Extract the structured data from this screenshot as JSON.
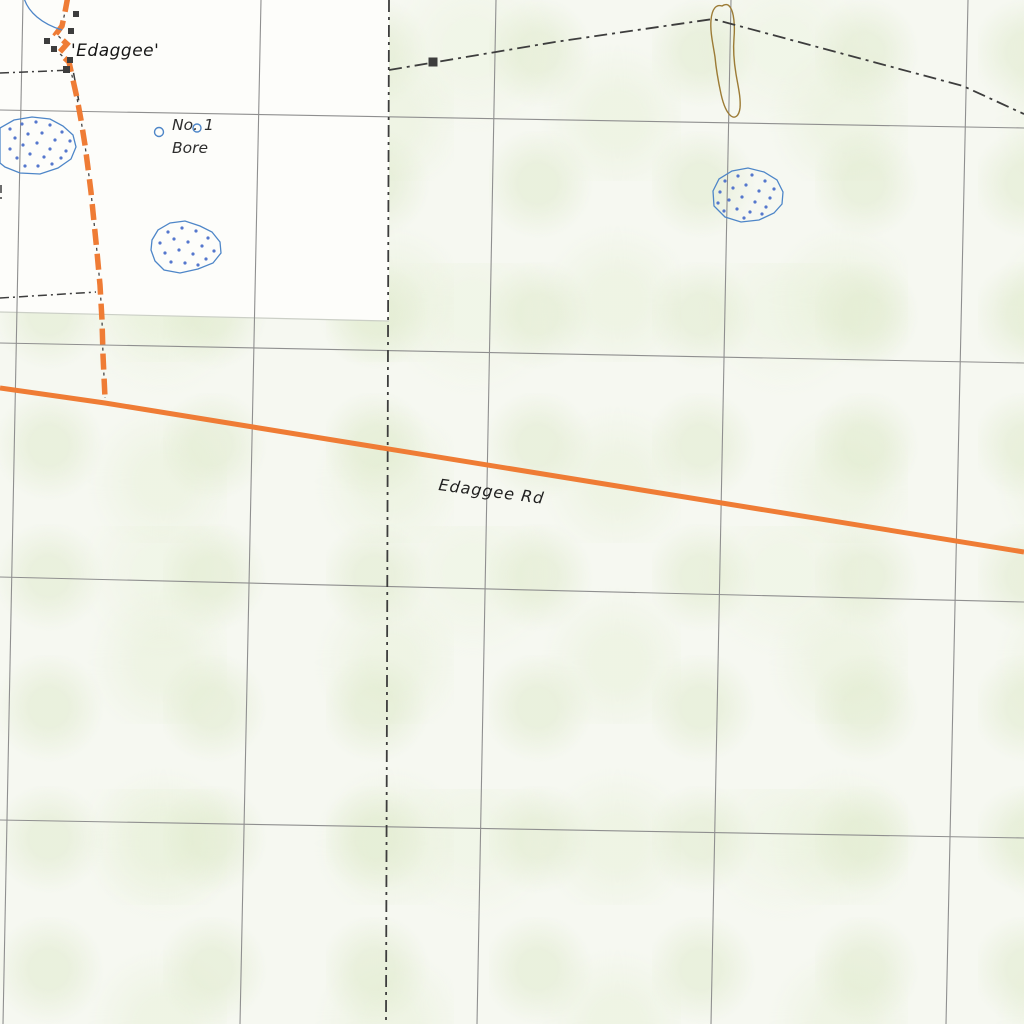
{
  "map": {
    "kind": "topographic-map-tile",
    "labels": {
      "homestead": "'Edaggee'",
      "bore_no": "No.",
      "bore_num": "1",
      "bore_word": "Bore",
      "road": "Edaggee Rd"
    },
    "features": {
      "homestead_building_squares": 6,
      "boundary_building_squares": 1,
      "bore_symbols": 2,
      "dotted_waterholes": 3,
      "contour_loops": 1,
      "grid_horizontals": 4,
      "grid_verticals": 5
    },
    "colors": {
      "background_tint": "#f6f8f1",
      "adjacent_sheet_white": "#fdfdfa",
      "road_track_orange": "#ef7c35",
      "water_outline_blue": "#4e86c8",
      "water_dot_blue": "#5577cd",
      "contour_brown": "#9c7b35",
      "grid_gray": "#8f8f8f",
      "boundary_dark": "#3d3d3d",
      "neatline_faint_gray": "#cbcfc6",
      "label_black": "#1a1a1a"
    }
  }
}
